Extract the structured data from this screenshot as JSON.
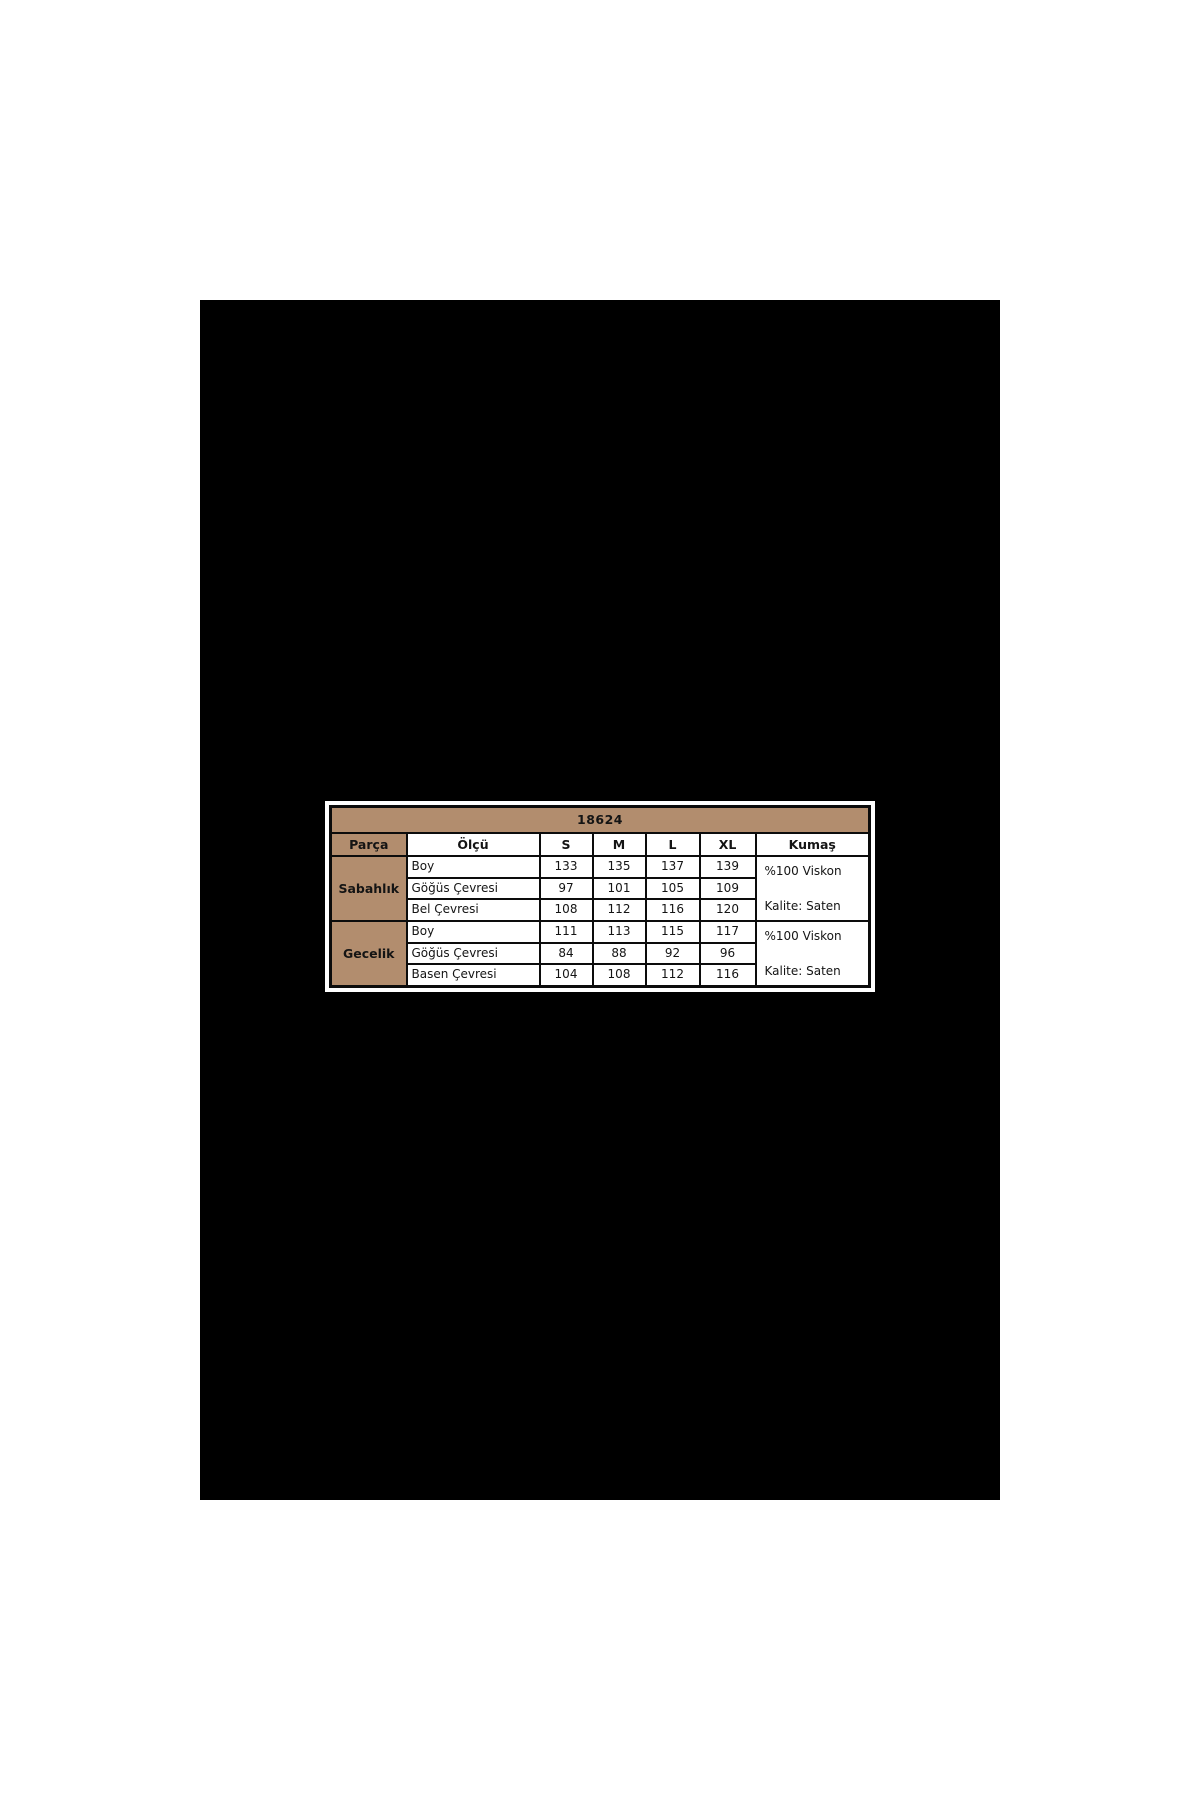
{
  "page": {
    "background": "#ffffff",
    "photo_background": "#000000"
  },
  "size_chart": {
    "code": "18624",
    "columns": [
      "Parça",
      "Ölçü",
      "S",
      "M",
      "L",
      "XL",
      "Kumaş"
    ],
    "groups": [
      {
        "part": "Sabahlık",
        "rows": [
          {
            "measure": "Boy",
            "values": [
              "133",
              "135",
              "137",
              "139"
            ]
          },
          {
            "measure": "Göğüs Çevresi",
            "values": [
              "97",
              "101",
              "105",
              "109"
            ]
          },
          {
            "measure": "Bel Çevresi",
            "values": [
              "108",
              "112",
              "116",
              "120"
            ]
          }
        ],
        "fabric": [
          "%100 Viskon",
          "Kalite: Saten"
        ]
      },
      {
        "part": "Gecelik",
        "rows": [
          {
            "measure": "Boy",
            "values": [
              "111",
              "113",
              "115",
              "117"
            ]
          },
          {
            "measure": "Göğüs Çevresi",
            "values": [
              "84",
              "88",
              "92",
              "96"
            ]
          },
          {
            "measure": "Basen Çevresi",
            "values": [
              "104",
              "108",
              "112",
              "116"
            ]
          }
        ],
        "fabric": [
          "%100 Viskon",
          "Kalite: Saten"
        ]
      }
    ],
    "colors": {
      "header_fill": "#b28d6e",
      "grid_line": "#0c0c0c",
      "cell_fill": "#ffffff",
      "text": "#141414"
    }
  }
}
